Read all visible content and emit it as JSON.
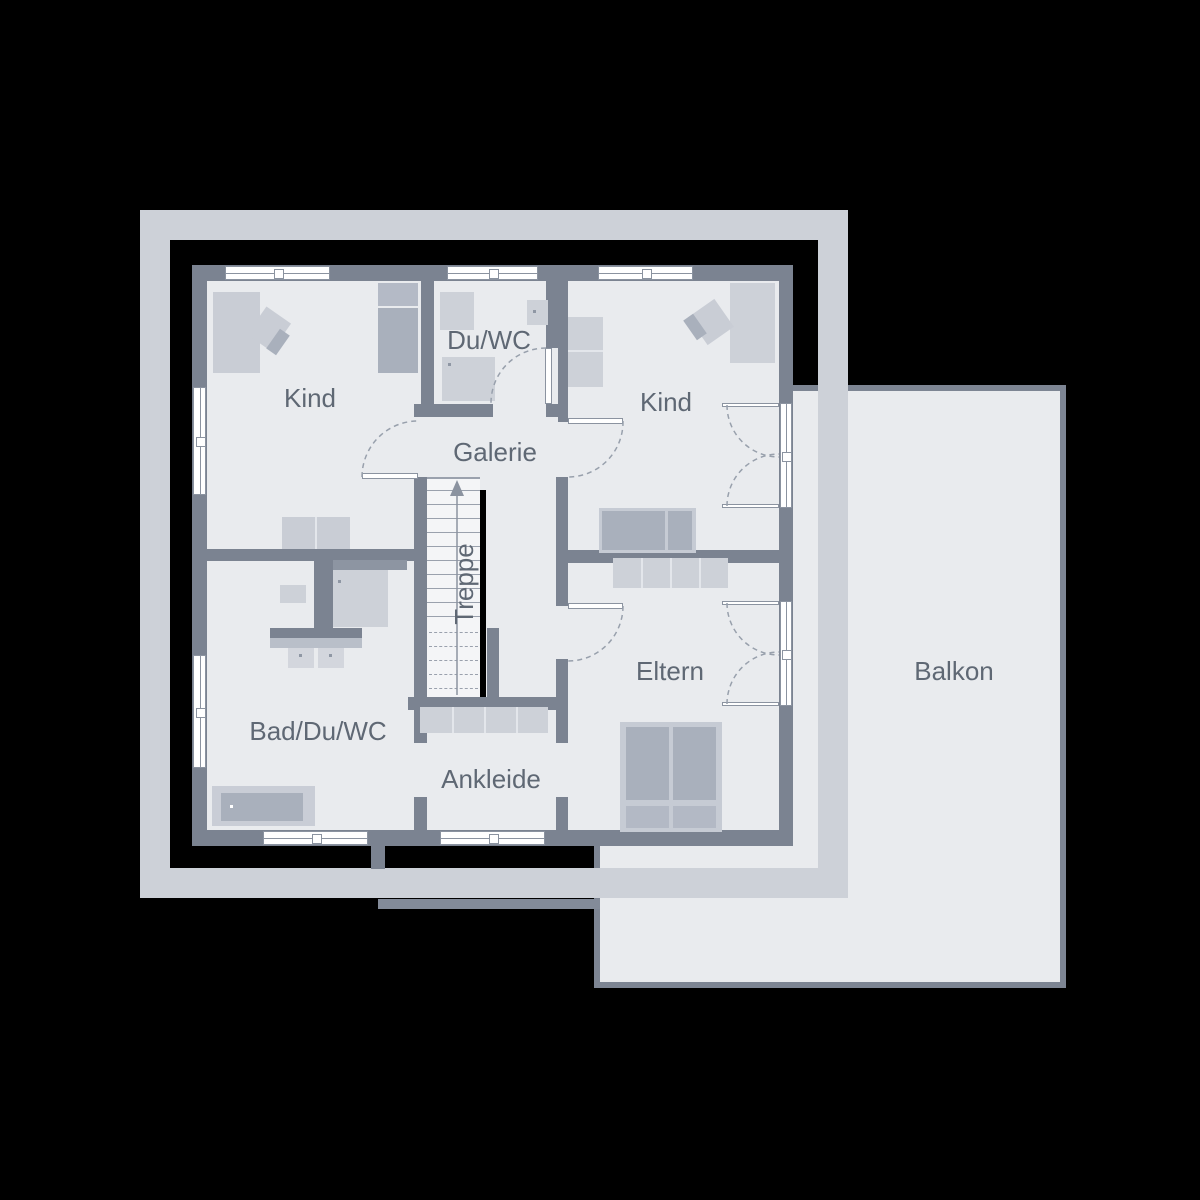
{
  "type": "architectural-floor-plan-upper-floor",
  "labels": {
    "kind_left": "Kind",
    "du_wc": "Du/WC",
    "kind_right": "Kind",
    "galerie": "Galerie",
    "treppe": "Treppe",
    "eltern": "Eltern",
    "bad_du_wc": "Bad/Du/WC",
    "ankleide": "Ankleide",
    "balkon": "Balkon"
  },
  "palette": {
    "background": "#000000",
    "roof_outline_frame": "#cdd1d8",
    "walls": "#7b8391",
    "floor": "#e9ebee",
    "furniture_light": "#cdd1d8",
    "furniture_medium": "#a9b0bc",
    "balcony_border": "#7d8593",
    "window_fill": "#ffffff",
    "window_line": "#8b93a0",
    "stair_cut_line": "#000000",
    "door_swing_dash": "#98a0ac",
    "text": "#5f6874"
  }
}
